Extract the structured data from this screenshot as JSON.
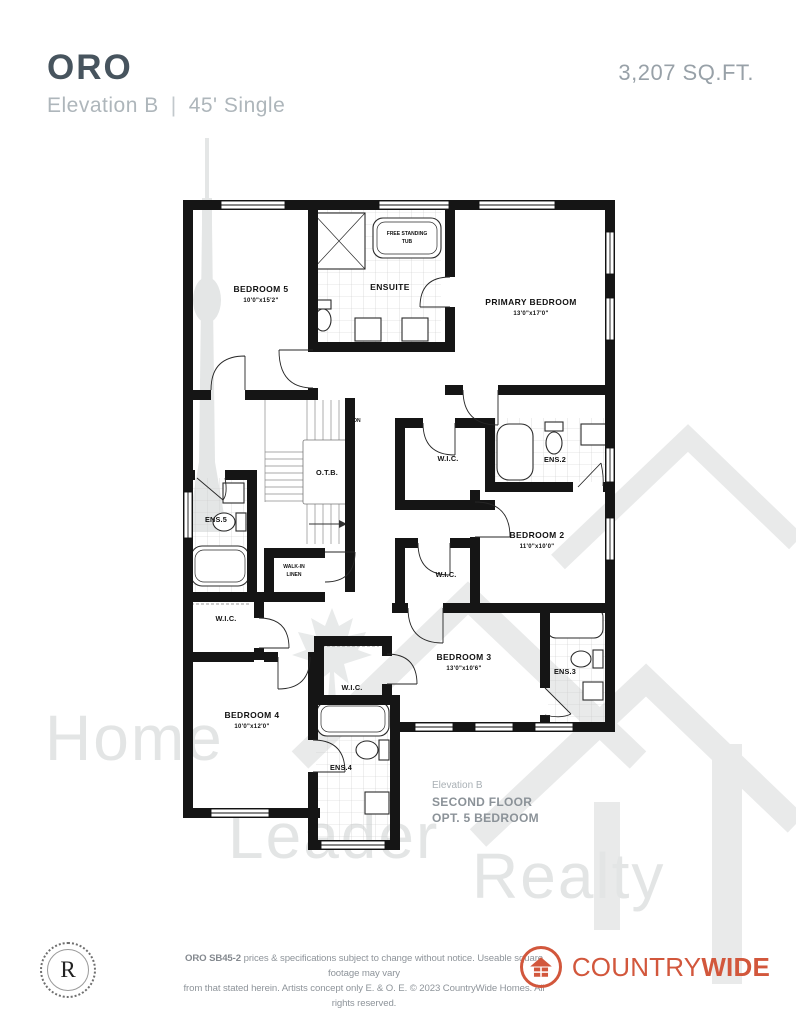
{
  "header": {
    "model": "ORO",
    "elevation": "Elevation B",
    "divider": "|",
    "width_type": "45' Single",
    "sqft": "3,207 SQ.FT."
  },
  "floorplan": {
    "labels": {
      "bedroom5_name": "BEDROOM 5",
      "bedroom5_dims": "10'0\"x15'2\"",
      "ensuite_name": "ENSUITE",
      "tub_line1": "FREE STANDING",
      "tub_line2": "TUB",
      "primary_name": "PRIMARY BEDROOM",
      "primary_dims": "13'0\"x17'0\"",
      "bedroom2_name": "BEDROOM 2",
      "bedroom2_dims": "11'0\"x10'0\"",
      "bedroom3_name": "BEDROOM 3",
      "bedroom3_dims": "13'0\"x10'6\"",
      "bedroom4_name": "BEDROOM 4",
      "bedroom4_dims": "10'0\"x12'0\"",
      "wic": "W.I.C.",
      "ens2": "ENS.2",
      "ens3": "ENS.3",
      "ens4": "ENS.4",
      "ens5": "ENS.5",
      "otb": "O.T.B.",
      "dn": "DN",
      "linen_line1": "WALK-IN",
      "linen_line2": "LINEN"
    },
    "annotation": {
      "line1": "Elevation B",
      "line2": "SECOND FLOOR",
      "line3": "OPT. 5 BEDROOM"
    }
  },
  "watermark": {
    "word1": "Home",
    "word2": "Leader",
    "word3": "Realty"
  },
  "footer": {
    "stamp_letter": "R",
    "disclaimer_bold": "ORO SB45-2",
    "disclaimer_rest": " prices & specifications subject to change without notice. Useable square footage may vary",
    "disclaimer_line2": "from that stated herein. Artists concept only E. & O. E. © 2023 CountryWide Homes. All rights reserved.",
    "brand_part1": "COUNTRY",
    "brand_part2": "WIDE"
  },
  "colors": {
    "brand_orange": "#d2573c",
    "title_slate": "#47545e",
    "muted_gray": "#aeb6bb",
    "plan_ink": "#151515",
    "watermark_gray": "#e3e5e5"
  }
}
